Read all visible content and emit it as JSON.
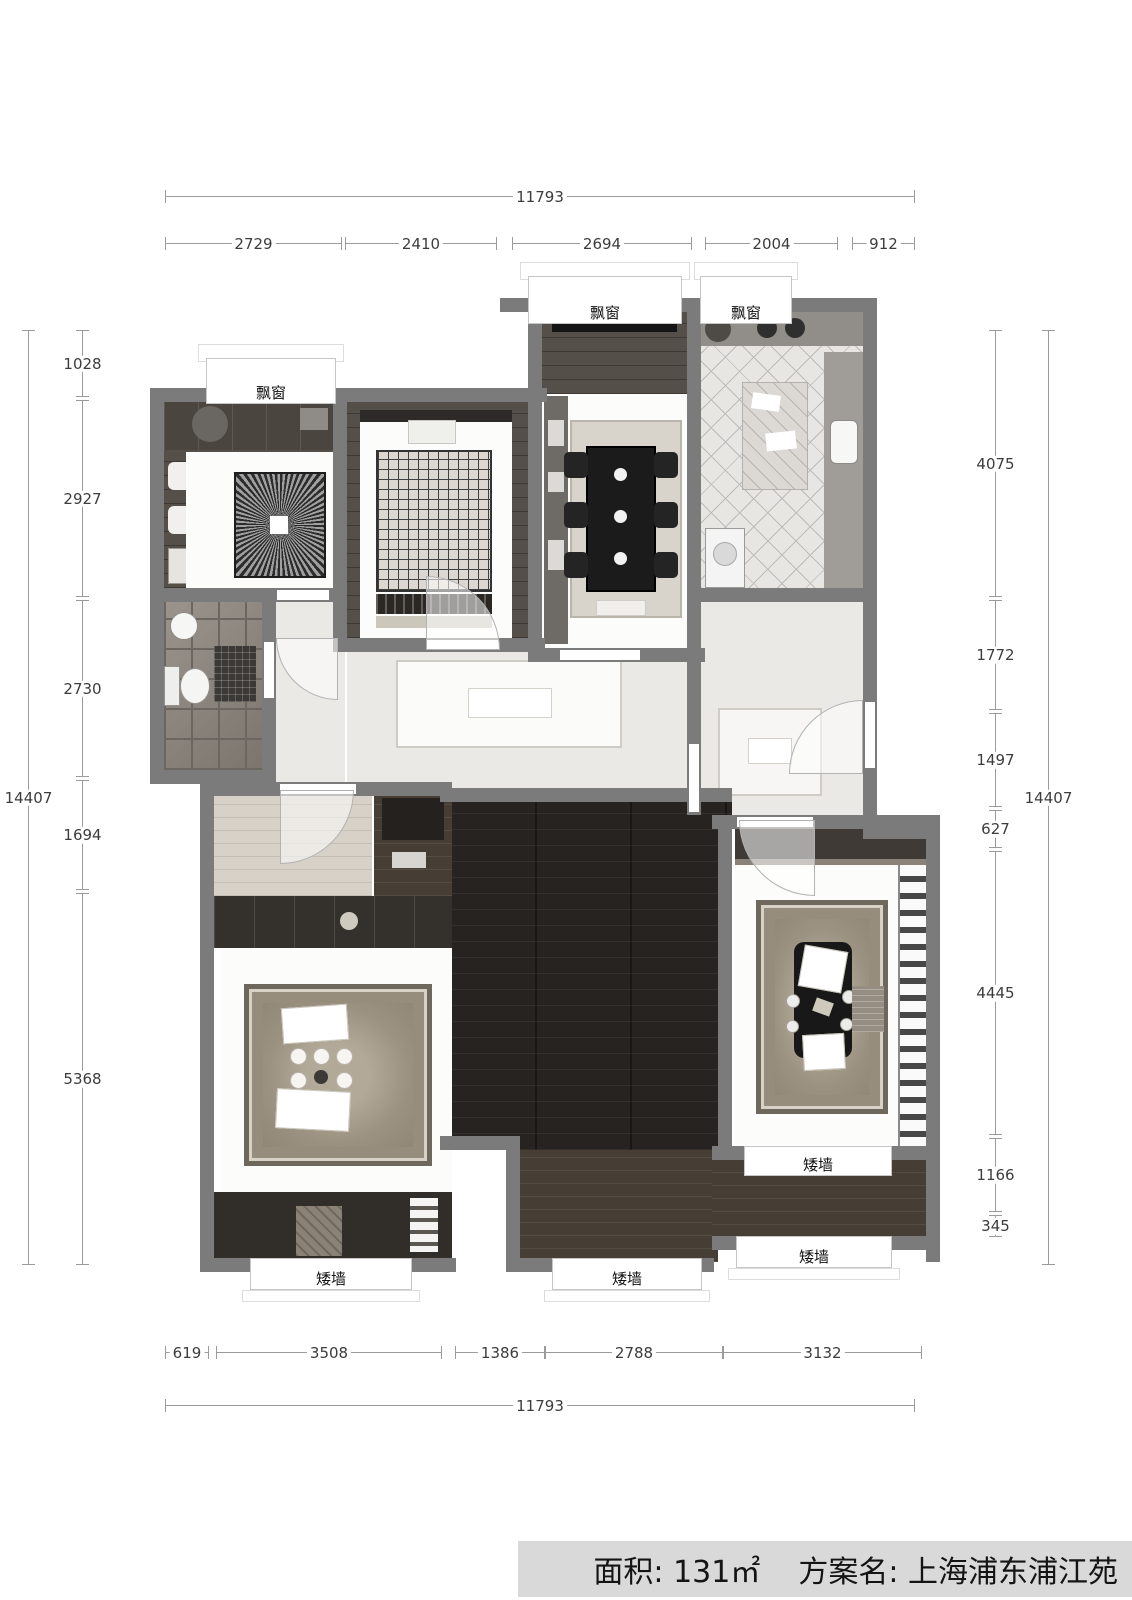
{
  "footer": {
    "area_label": "面积:",
    "area_value": "131㎡",
    "plan_name_label": "方案名:",
    "plan_name_value": "上海浦东浦江苑"
  },
  "annotations": {
    "bay_window": "飘窗",
    "low_wall": "矮墙"
  },
  "dimensions": {
    "top": {
      "total": "11793",
      "segments": [
        "2729",
        "2410",
        "2694",
        "2004",
        "912"
      ]
    },
    "bottom": {
      "total": "11793",
      "segments": [
        "619",
        "3508",
        "1386",
        "2788",
        "3132"
      ]
    },
    "left": {
      "total": "14407",
      "segments": [
        "1028",
        "2927",
        "2730",
        "1694",
        "5368"
      ]
    },
    "right": {
      "total": "14407",
      "segments": [
        "4075",
        "1772",
        "1497",
        "627",
        "4445",
        "1166",
        "345"
      ]
    }
  },
  "colors": {
    "wall": "#7b7b7b",
    "dark_floor": "#262320",
    "footer_bg": "#d9d9d9"
  }
}
